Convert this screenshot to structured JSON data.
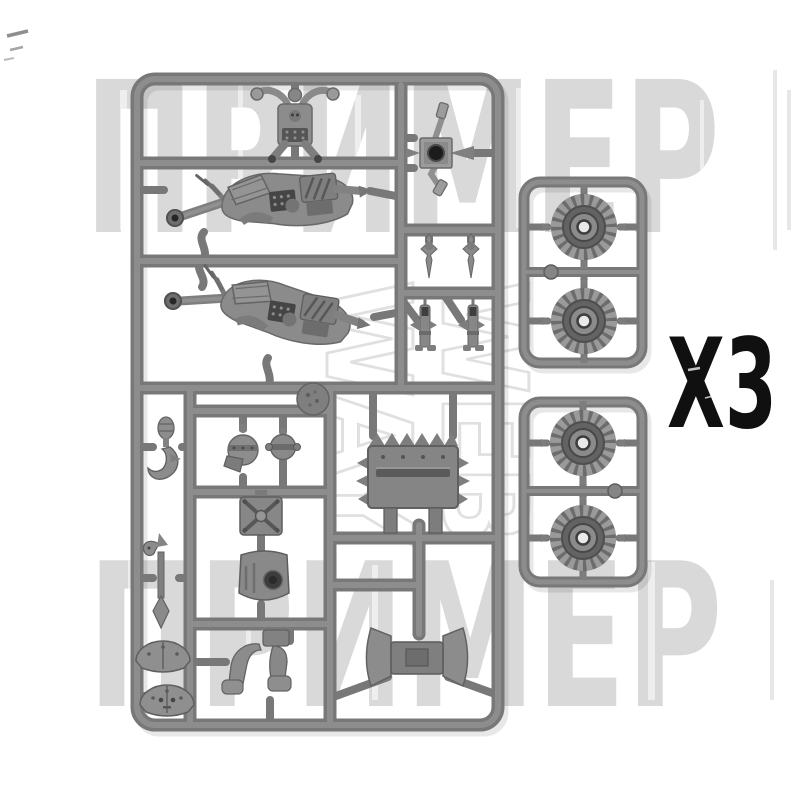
{
  "page": {
    "description": "Product photo of gray plastic model kit sprues: one large parts sprue and two small wheel sprues, quantity marked X3, with store watermarks",
    "background": "#ffffff"
  },
  "watermarks": {
    "top_text": "ПРИМЕР",
    "bottom_text": "ПРИМЕР",
    "center_line1": "WEB",
    "center_line2": "WAY",
    "text_color": "#d6d6d6",
    "outline_color": "#c7c7c7"
  },
  "quantity_label": {
    "text": "X3",
    "color": "#101010"
  },
  "colors": {
    "sprue_frame": "#787878",
    "runner_highlight": "#8d8d8d",
    "part_base": "#8a8a8a",
    "part_mid": "#6f6f6f",
    "part_dark": "#474747",
    "hole_dark": "#1c1c1c",
    "wheel_teeth": "#9a9a9a",
    "wheel_base": "#6c6c6c",
    "wheel_recess": "#4f4f4f",
    "wheel_hub": "#8b8b8b",
    "wheel_hole": "#e9e9e9"
  },
  "sprues": {
    "main_sprue_parts": [
      "engine-exhaust",
      "axle-cross",
      "warbike-body-1",
      "warbike-body-2",
      "spike-dagger-1",
      "spike-dagger-2",
      "exhaust-pipe-1",
      "exhaust-pipe-2",
      "round-boss",
      "claw",
      "axe",
      "shoulder-pad-1",
      "shoulder-pad-2",
      "head-1",
      "head-2",
      "torso-box",
      "armor-plate-small",
      "legs",
      "spiked-front-plate",
      "saddle"
    ],
    "wheel_sprue_count": 2,
    "wheels_per_sprue": 2
  }
}
